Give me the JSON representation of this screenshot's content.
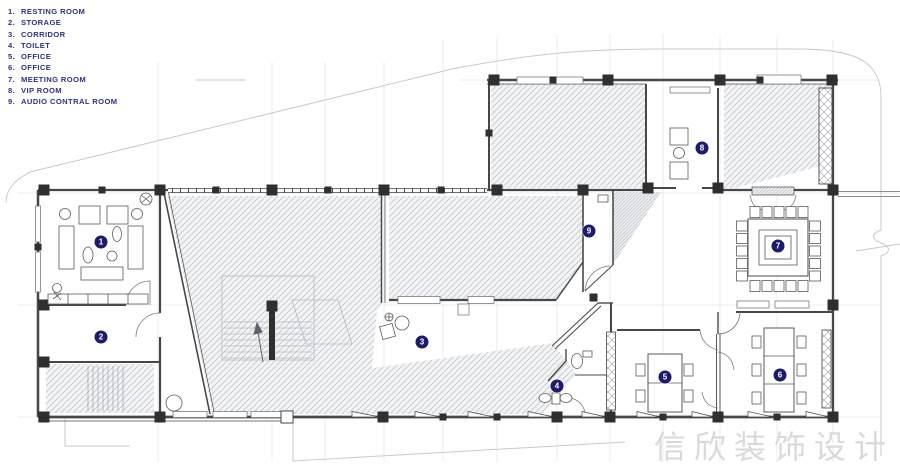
{
  "legend": {
    "items": [
      {
        "num": "1.",
        "label": "RESTING ROOM"
      },
      {
        "num": "2.",
        "label": "STORAGE"
      },
      {
        "num": "3.",
        "label": "CORRIDOR"
      },
      {
        "num": "4.",
        "label": "TOILET"
      },
      {
        "num": "5.",
        "label": "OFFICE"
      },
      {
        "num": "6.",
        "label": "OFFICE"
      },
      {
        "num": "7.",
        "label": "MEETING ROOM"
      },
      {
        "num": "8.",
        "label": "VIP ROOM"
      },
      {
        "num": "9.",
        "label": "AUDIO CONTRAL ROOM"
      }
    ]
  },
  "plan": {
    "markers": [
      {
        "num": "1",
        "x": 101,
        "y": 242
      },
      {
        "num": "2",
        "x": 101,
        "y": 337
      },
      {
        "num": "3",
        "x": 422,
        "y": 342
      },
      {
        "num": "4",
        "x": 557,
        "y": 386
      },
      {
        "num": "5",
        "x": 665,
        "y": 377
      },
      {
        "num": "6",
        "x": 780,
        "y": 375
      },
      {
        "num": "7",
        "x": 778,
        "y": 246
      },
      {
        "num": "8",
        "x": 702,
        "y": 148
      },
      {
        "num": "9",
        "x": 589,
        "y": 231
      }
    ]
  },
  "watermark": {
    "text": "信欣装饰设计"
  },
  "colors": {
    "legend_text": "#2c3380",
    "marker_bg": "#1d1b6b",
    "marker_text": "#ffffff",
    "watermark": "#d9d9d7"
  }
}
